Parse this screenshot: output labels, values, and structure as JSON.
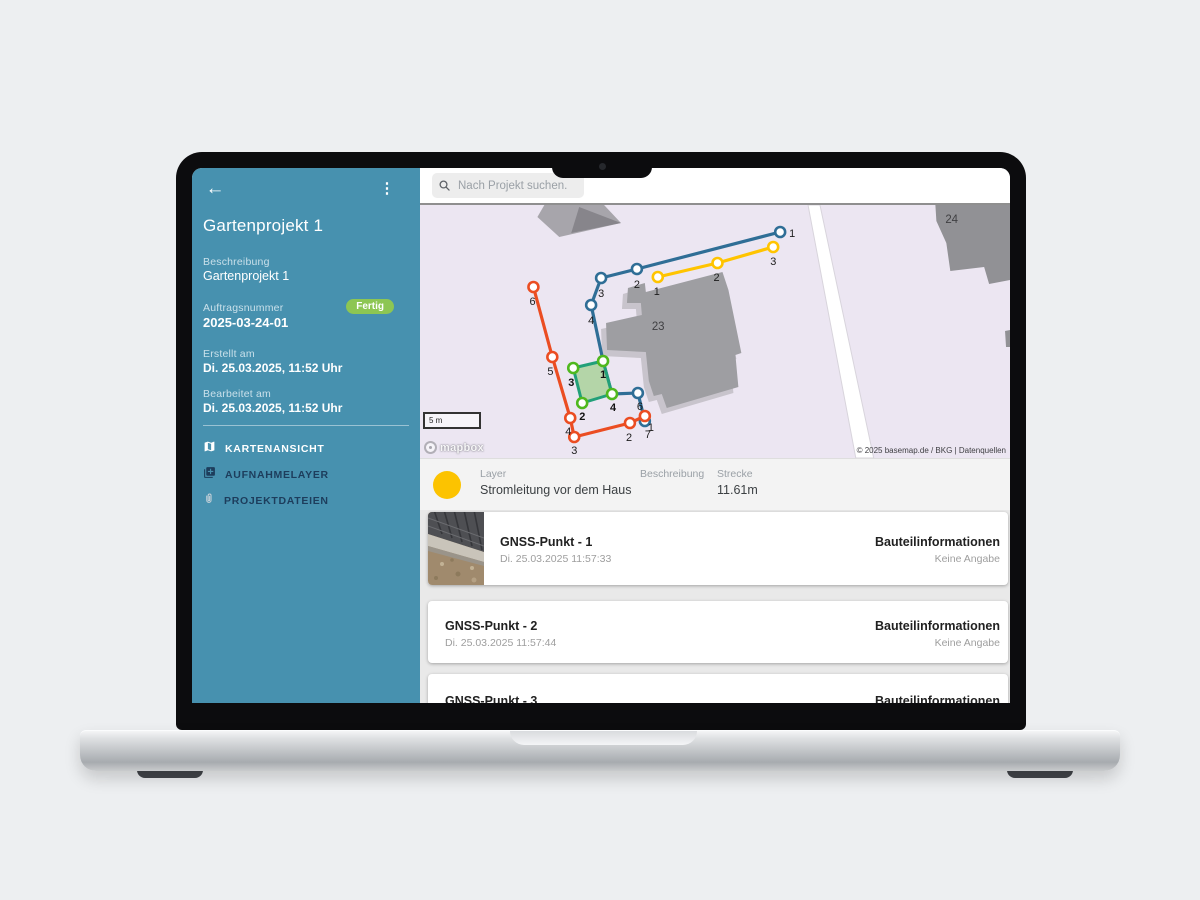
{
  "sidebar": {
    "title": "Gartenprojekt 1",
    "fields": [
      {
        "label": "Beschreibung",
        "value": "Gartenprojekt 1"
      },
      {
        "label": "Auftragsnummer",
        "value": "2025-03-24-01",
        "badge": "Fertig"
      },
      {
        "label": "Erstellt am",
        "value": "Di. 25.03.2025, 11:52 Uhr"
      },
      {
        "label": "Bearbeitet am",
        "value": "Di. 25.03.2025, 11:52 Uhr"
      }
    ],
    "nav": [
      {
        "label": "KARTENANSICHT",
        "icon": "map-icon",
        "active": true
      },
      {
        "label": "AUFNAHMELAYER",
        "icon": "layers-plus-icon",
        "active": false
      },
      {
        "label": "PROJEKTDATEIEN",
        "icon": "paperclip-icon",
        "active": false
      }
    ],
    "colors": {
      "bg": "#4791af",
      "badge": "#8dc653"
    }
  },
  "header": {
    "search_placeholder": "Nach Projekt suchen."
  },
  "map": {
    "scale_label": "5 m",
    "logo_text": "mapbox",
    "attribution": "© 2025 basemap.de / BKG | Datenquellen",
    "background": "#ece6f2",
    "road": {
      "points": [
        [
          390,
          0
        ],
        [
          402,
          0
        ],
        [
          456,
          253
        ],
        [
          438,
          253
        ]
      ],
      "fill": "#ffffff",
      "stroke": "#d8d4dc"
    },
    "buildings": [
      {
        "label": "",
        "fill": "#a7a5ab",
        "points": [
          [
            125,
            0
          ],
          [
            185,
            0
          ],
          [
            202,
            18
          ],
          [
            140,
            32
          ],
          [
            118,
            12
          ]
        ]
      },
      {
        "label": "",
        "fill": "#87858b",
        "points": [
          [
            160,
            2
          ],
          [
            202,
            18
          ],
          [
            152,
            28
          ]
        ]
      },
      {
        "label": "23",
        "labelPos": [
          233,
          125
        ],
        "fill": "#9e9ea2",
        "shadow": "#c8c4cc",
        "points": [
          [
            209,
            83
          ],
          [
            226,
            78
          ],
          [
            227,
            87
          ],
          [
            304,
            67
          ],
          [
            310,
            85
          ],
          [
            323,
            148
          ],
          [
            317,
            150
          ],
          [
            320,
            182
          ],
          [
            248,
            203
          ],
          [
            243,
            189
          ],
          [
            235,
            191
          ],
          [
            230,
            176
          ],
          [
            227,
            147
          ],
          [
            188,
            145
          ],
          [
            187,
            118
          ],
          [
            223,
            110
          ],
          [
            222,
            98
          ],
          [
            208,
            98
          ]
        ]
      },
      {
        "label": "24",
        "labelPos": [
          528,
          18
        ],
        "fill": "#919195",
        "points": [
          [
            518,
            0
          ],
          [
            593,
            0
          ],
          [
            593,
            75
          ],
          [
            572,
            79
          ],
          [
            567,
            62
          ],
          [
            533,
            66
          ],
          [
            529,
            38
          ],
          [
            519,
            16
          ]
        ]
      },
      {
        "label": "",
        "fill": "#919195",
        "points": [
          [
            588,
            126
          ],
          [
            593,
            125
          ],
          [
            593,
            142
          ],
          [
            589,
            142
          ]
        ]
      }
    ],
    "layers": [
      {
        "name": "blue-line",
        "color": "#2f6e96",
        "closed": false,
        "path": [
          [
            362,
            27
          ],
          [
            218,
            64
          ],
          [
            182,
            73
          ],
          [
            172,
            100
          ],
          [
            184,
            156
          ],
          [
            193,
            189
          ],
          [
            219,
            188
          ],
          [
            226,
            216
          ]
        ],
        "markers": [
          {
            "label": "1",
            "x": 362,
            "y": 27,
            "lx": 371,
            "ly": 32
          },
          {
            "label": "2",
            "x": 218,
            "y": 64,
            "lx": 215,
            "ly": 83
          },
          {
            "label": "3",
            "x": 182,
            "y": 73,
            "lx": 179,
            "ly": 92
          },
          {
            "label": "4",
            "x": 172,
            "y": 100,
            "lx": 169,
            "ly": 119
          },
          {
            "label": "6",
            "x": 219,
            "y": 188,
            "lx": 218,
            "ly": 205
          },
          {
            "label": "7",
            "x": 226,
            "y": 216,
            "lx": 226,
            "ly": 233
          }
        ]
      },
      {
        "name": "yellow-line",
        "color": "#ffc400",
        "closed": false,
        "path": [
          [
            239,
            72
          ],
          [
            299,
            58
          ],
          [
            355,
            42
          ]
        ],
        "markers": [
          {
            "label": "1",
            "x": 239,
            "y": 72,
            "lx": 235,
            "ly": 90
          },
          {
            "label": "2",
            "x": 299,
            "y": 58,
            "lx": 295,
            "ly": 76
          },
          {
            "label": "3",
            "x": 355,
            "y": 42,
            "lx": 352,
            "ly": 60
          }
        ]
      },
      {
        "name": "orange-line",
        "color": "#eb4d22",
        "closed": false,
        "path": [
          [
            114,
            82
          ],
          [
            133,
            152
          ],
          [
            151,
            213
          ],
          [
            155,
            232
          ],
          [
            211,
            218
          ],
          [
            226,
            211
          ]
        ],
        "markers": [
          {
            "label": "6",
            "x": 114,
            "y": 82,
            "lx": 110,
            "ly": 100
          },
          {
            "label": "5",
            "x": 133,
            "y": 152,
            "lx": 128,
            "ly": 170
          },
          {
            "label": "4",
            "x": 151,
            "y": 213,
            "lx": 146,
            "ly": 230
          },
          {
            "label": "3",
            "x": 155,
            "y": 232,
            "lx": 152,
            "ly": 249
          },
          {
            "label": "2",
            "x": 211,
            "y": 218,
            "lx": 207,
            "ly": 236
          },
          {
            "label": "1",
            "x": 226,
            "y": 211,
            "lx": 229,
            "ly": 226
          }
        ]
      },
      {
        "name": "green-area",
        "color": "#22a079",
        "closed": true,
        "fill": "rgba(151,205,128,0.65)",
        "markerColor": "#4fb81e",
        "bold": true,
        "path": [
          [
            184,
            156
          ],
          [
            193,
            189
          ],
          [
            163,
            198
          ],
          [
            154,
            163
          ]
        ],
        "markers": [
          {
            "label": "1",
            "x": 184,
            "y": 156,
            "lx": 181,
            "ly": 173
          },
          {
            "label": "4",
            "x": 193,
            "y": 189,
            "lx": 191,
            "ly": 206
          },
          {
            "label": "2",
            "x": 163,
            "y": 198,
            "lx": 160,
            "ly": 215
          },
          {
            "label": "3",
            "x": 154,
            "y": 163,
            "lx": 149,
            "ly": 181
          }
        ]
      }
    ]
  },
  "layer_panel": {
    "layer_label": "Layer",
    "layer_value": "Stromleitung vor dem Haus",
    "beschreibung_label": "Beschreibung",
    "strecke_label": "Strecke",
    "strecke_value": "11.61m",
    "dot_color": "#fcc300"
  },
  "points_list": [
    {
      "title": "GNSS-Punkt - 1",
      "timestamp": "Di. 25.03.2025 11:57:33",
      "details_label": "Bauteilinformationen",
      "details_value": "Keine Angabe"
    },
    {
      "title": "GNSS-Punkt - 2",
      "timestamp": "Di. 25.03.2025 11:57:44",
      "details_label": "Bauteilinformationen",
      "details_value": "Keine Angabe"
    },
    {
      "title": "GNSS-Punkt - 3",
      "details_label": "Bauteilinformationen"
    }
  ]
}
